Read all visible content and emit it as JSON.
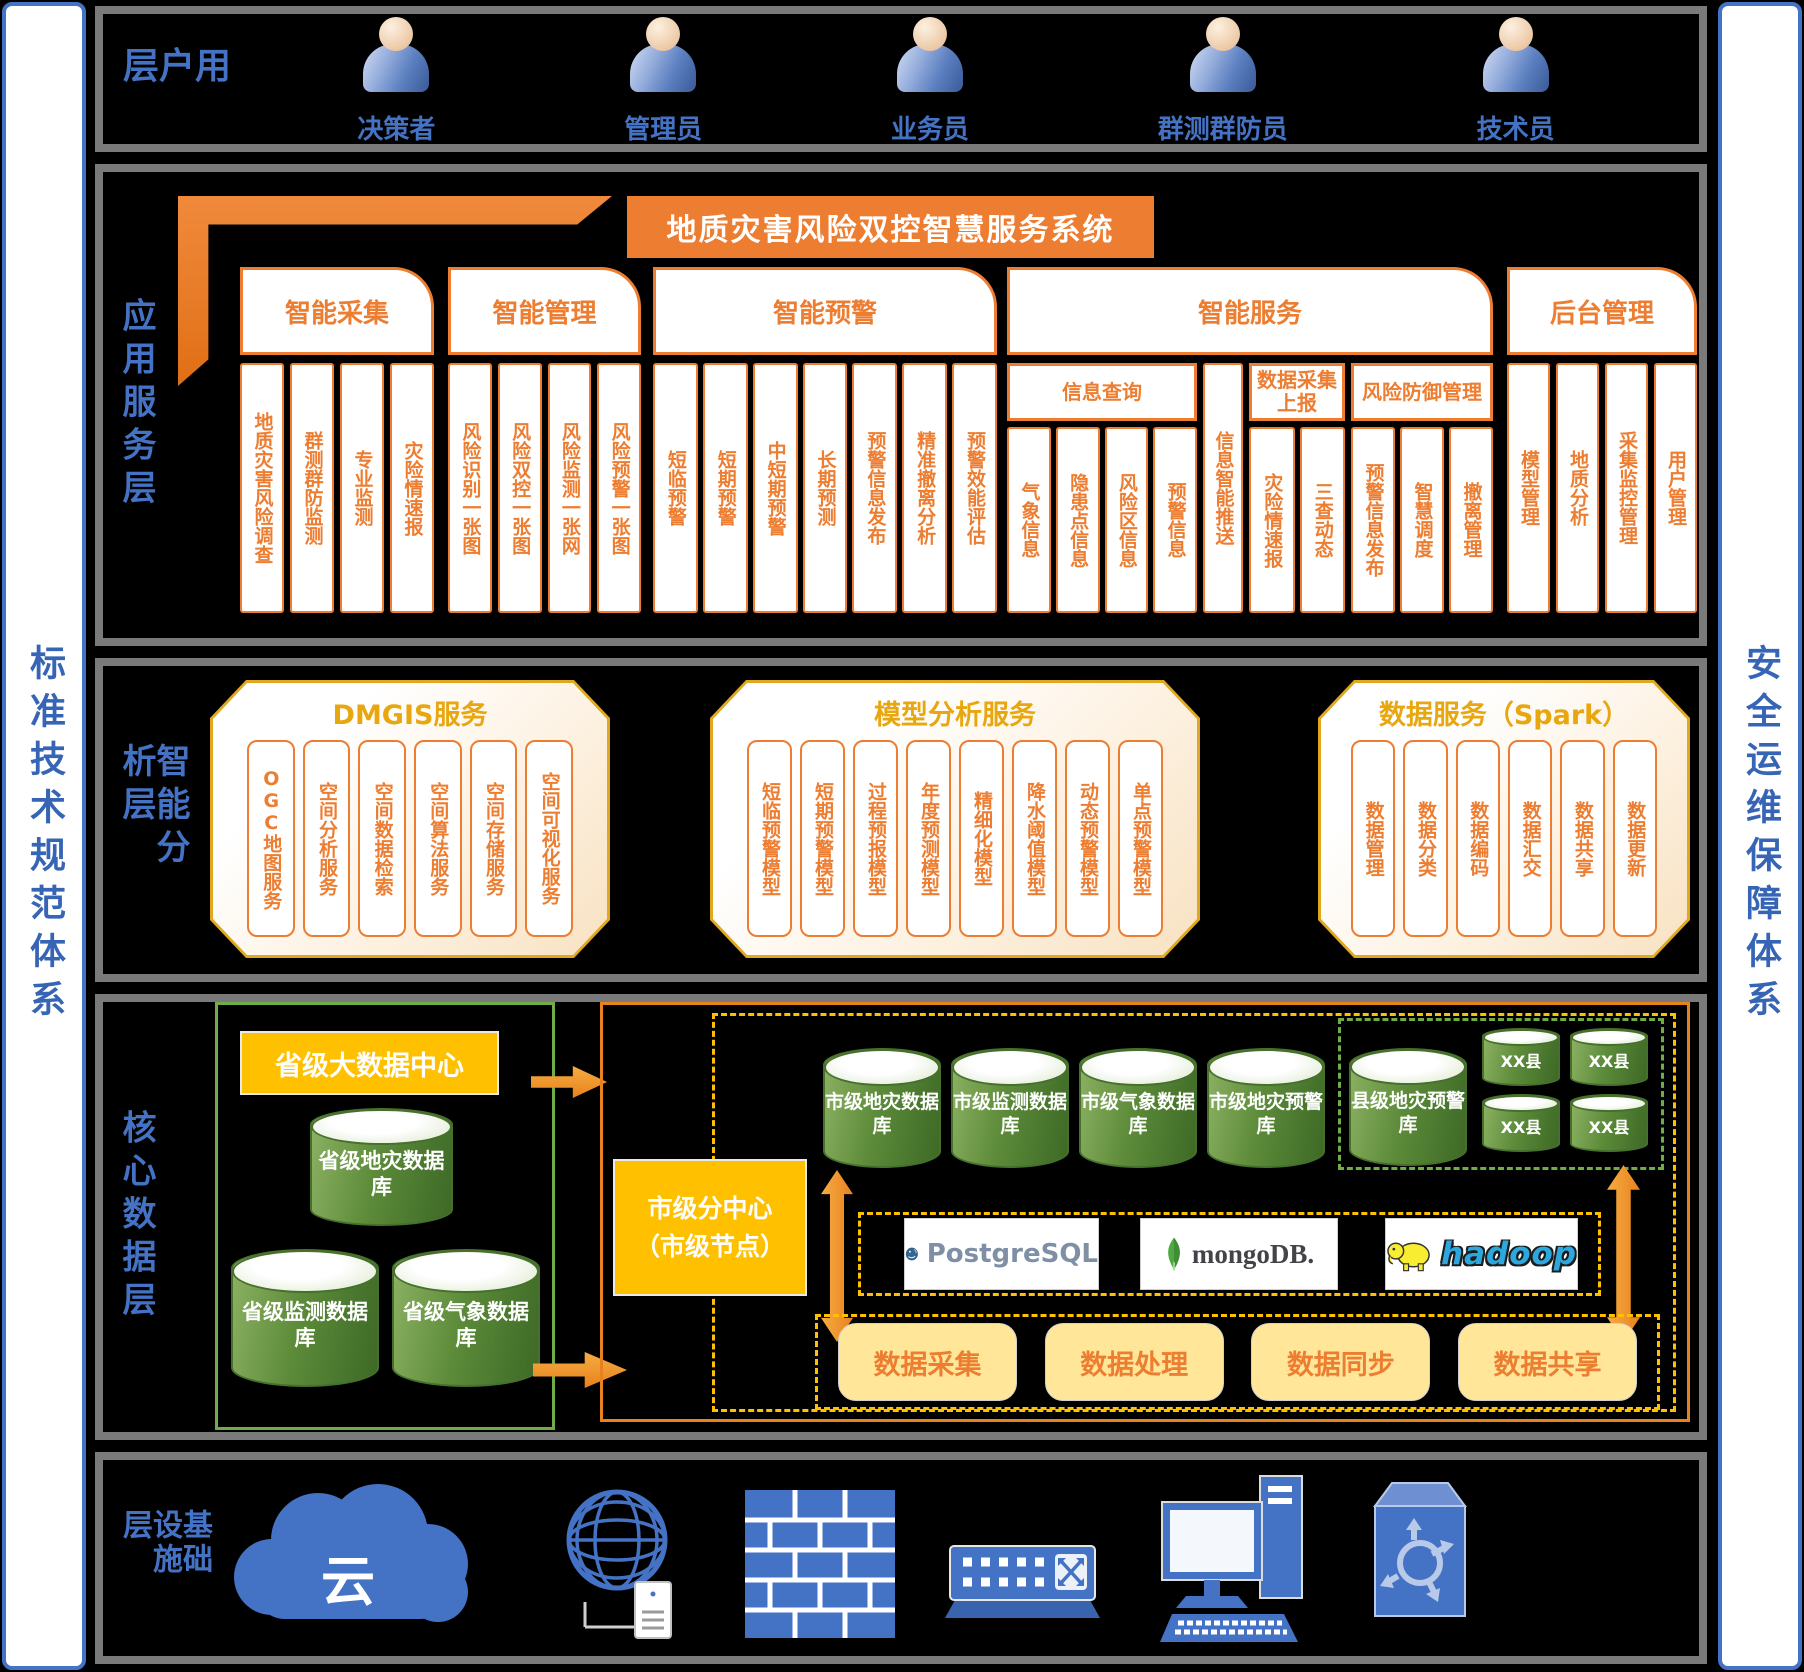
{
  "rails": {
    "left": "标准技术规范体系",
    "right": "安全运维保障体系"
  },
  "user_layer": {
    "label": "用户层",
    "users": [
      "决策者",
      "管理员",
      "业务员",
      "群测群防员",
      "技术员"
    ]
  },
  "app_layer": {
    "label": "应用服务层",
    "system_title": "地质灾害风险双控智慧服务系统",
    "groups": [
      {
        "title": "智能采集",
        "cols": [
          "地质灾害风险调查",
          "群测群防监测",
          "专业监测",
          "灾险情速报"
        ]
      },
      {
        "title": "智能管理",
        "cols": [
          "风险识别一张图",
          "风险双控一张图",
          "风险监测一张网",
          "风险预警一张图"
        ]
      },
      {
        "title": "智能预警",
        "cols": [
          "短临预警",
          "短期预警",
          "中短期预警",
          "长期预测",
          "预警信息发布",
          "精准撤离分析",
          "预警效能评估"
        ]
      },
      {
        "title": "智能服务",
        "subgroups": [
          {
            "title": "信息查询",
            "cols": [
              "气象信息",
              "隐患点信息",
              "风险区信息",
              "预警信息"
            ]
          },
          {
            "title": "",
            "cols": [
              "信息智能推送"
            ]
          },
          {
            "title": "数据采集上报",
            "cols": [
              "灾险情速报",
              "三查动态"
            ]
          },
          {
            "title": "风险防御管理",
            "cols": [
              "预警信息发布",
              "智慧调度",
              "撤离管理"
            ]
          }
        ]
      },
      {
        "title": "后台管理",
        "cols": [
          "模型管理",
          "地质分析",
          "采集监控管理",
          "用户管理"
        ]
      }
    ]
  },
  "analysis_layer": {
    "label": "智能分析层",
    "blocks": [
      {
        "title": "DMGIS服务",
        "cols": [
          "OGC地图服务",
          "空间分析服务",
          "空间数据检索",
          "空间算法服务",
          "空间存储服务",
          "空间可视化服务"
        ]
      },
      {
        "title": "模型分析服务",
        "cols": [
          "短临预警模型",
          "短期预警模型",
          "过程预报模型",
          "年度预测模型",
          "精细化模型",
          "降水阈值模型",
          "动态预警模型",
          "单点预警模型"
        ]
      },
      {
        "title": "数据服务（Spark）",
        "cols": [
          "数据管理",
          "数据分类",
          "数据编码",
          "数据汇交",
          "数据共享",
          "数据更新"
        ]
      }
    ]
  },
  "core_layer": {
    "label": "核心数据层",
    "province_center": "省级大数据中心",
    "province_dbs": [
      "省级地灾数据库",
      "省级监测数据库",
      "省级气象数据库"
    ],
    "city_node": {
      "line1": "市级分中心",
      "line2": "（市级节点）"
    },
    "city_dbs": [
      "市级地灾数据库",
      "市级监测数据库",
      "市级气象数据库",
      "市级地灾预警库"
    ],
    "county_db": "县级地灾预警库",
    "county_nodes": [
      "XX县",
      "XX县",
      "XX县",
      "XX县"
    ],
    "middleware": [
      "PostgreSQL",
      "mongoDB.",
      "hadoop"
    ],
    "pipeline": [
      "数据采集",
      "数据处理",
      "数据同步",
      "数据共享"
    ]
  },
  "infra_layer": {
    "label": "基础设施层",
    "cloud_text": "云"
  },
  "colors": {
    "orange": "#ED7D31",
    "gold": "#FFC000",
    "octagon_border": "#DFA81F",
    "db_green": "#5d8c3a",
    "green_border": "#70AD47",
    "blue": "#4472C4",
    "light_yellow": "#FFE699",
    "panel_border": "#7a7a7a"
  }
}
